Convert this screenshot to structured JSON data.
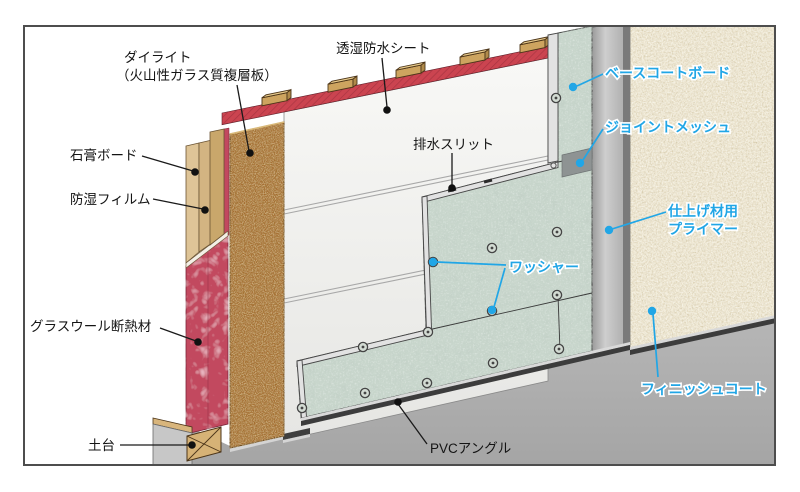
{
  "labels": {
    "dailite_1": "ダイライト",
    "dailite_2": "（火山性ガラス質複層板）",
    "toushitsu": "透湿防水シート",
    "sekkou": "石膏ボード",
    "boushitsu": "防湿フィルム",
    "glasswool": "グラスウール断熱材",
    "dodai": "土台",
    "haisui": "排水スリット",
    "basecoat": "ベースコートボード",
    "joint_mesh": "ジョイントメッシュ",
    "primer_1": "仕上げ材用",
    "primer_2": "プライマー",
    "washer": "ワッシャー",
    "finish_coat": "フィニッシュコート",
    "pvc": "PVCアングル"
  },
  "colors": {
    "label_black": "#141414",
    "accent_cyan": "#21a6e6",
    "insulation_red": "#c2485f",
    "strip_red": "#cb4450",
    "wood_tan": "#d3b482",
    "wood_light": "#dec497",
    "stud_tan": "#c9a76b",
    "dailite_brown": "#a56d2e",
    "board_green": "#c8d6cc",
    "finish_cream": "#ede5cf",
    "primer_gray": "#b5b5b5",
    "ground_gray": "#aeaeae",
    "pvc_dark": "#3c3c3c",
    "sheet_white": "#f4f4f1"
  }
}
